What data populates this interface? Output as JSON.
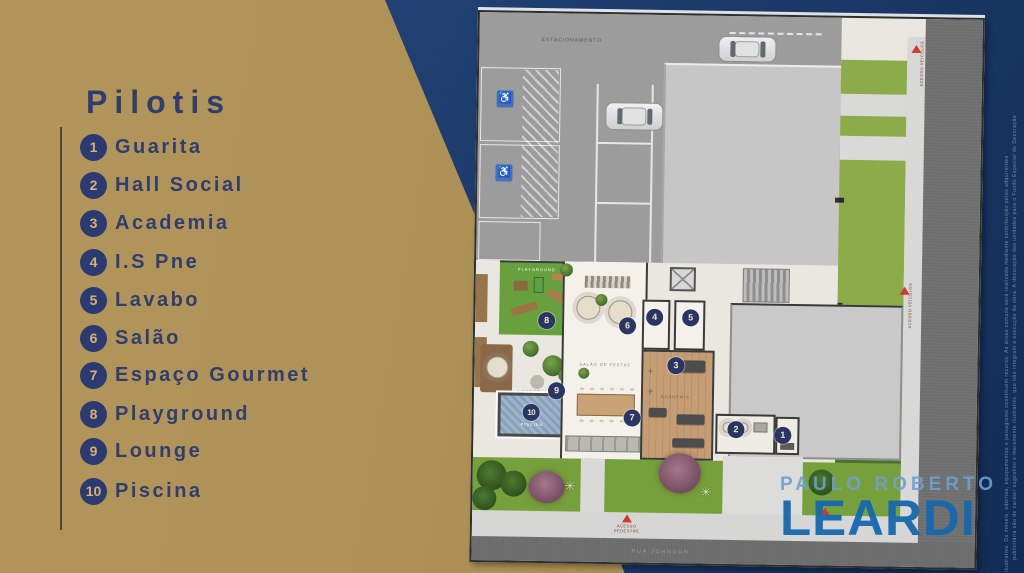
{
  "panel": {
    "title": "Pilotis"
  },
  "legend": {
    "items": [
      {
        "number": "1",
        "label": "Guarita"
      },
      {
        "number": "2",
        "label": "Hall Social"
      },
      {
        "number": "3",
        "label": "Academia"
      },
      {
        "number": "4",
        "label": "I.S Pne"
      },
      {
        "number": "5",
        "label": "Lavabo"
      },
      {
        "number": "6",
        "label": "Salão"
      },
      {
        "number": "7",
        "label": "Espaço Gourmet"
      },
      {
        "number": "8",
        "label": "Playground"
      },
      {
        "number": "9",
        "label": "Lounge"
      },
      {
        "number": "10",
        "label": "Piscina"
      }
    ]
  },
  "plan": {
    "badges": [
      "1",
      "2",
      "3",
      "4",
      "5",
      "6",
      "7",
      "8",
      "9",
      "10"
    ],
    "labels": {
      "parking": "ESTACIONAMENTO",
      "playground": "PLAYGROUND",
      "lounge": "LOUNGE",
      "pool": "PISCINA",
      "salao": "SALÃO DE FESTAS",
      "academia": "ACADEMIA",
      "street": "RUA JOHNSON",
      "pedestrian_access": "ACESSO\nPEDESTRE",
      "vehicle_access": "ACESSO\nVEÍCULOS"
    },
    "icons": {
      "wheelchair": "♿",
      "palm": "✳",
      "access_triangle": "▲"
    }
  },
  "logo": {
    "line1": "PAULO ROBERTO",
    "line2": "LEARDI"
  },
  "disclaimer": {
    "line1": "publicitária são de caráter sugestivo e meramente ilustrativo, que não integram a execução da obra. A decoração das unidades para o Fundo Especial de Decoração",
    "line2": "ilustrativa. Os móveis, adornos, equipamentos e paisagismo constituem recurso. As áreas comuns será realizada mediante contribuição pelos adquirentes"
  },
  "colors": {
    "gold_panel": "#ab8f53",
    "navy_background": "#1d3c6c",
    "legend_text": "#303d6e",
    "legend_circle": "#2c3a72",
    "badge": "#2b3564",
    "logo_light_blue": "#6f9fd3",
    "logo_blue": "#1668b0",
    "marker_red": "#cf3a2c"
  }
}
